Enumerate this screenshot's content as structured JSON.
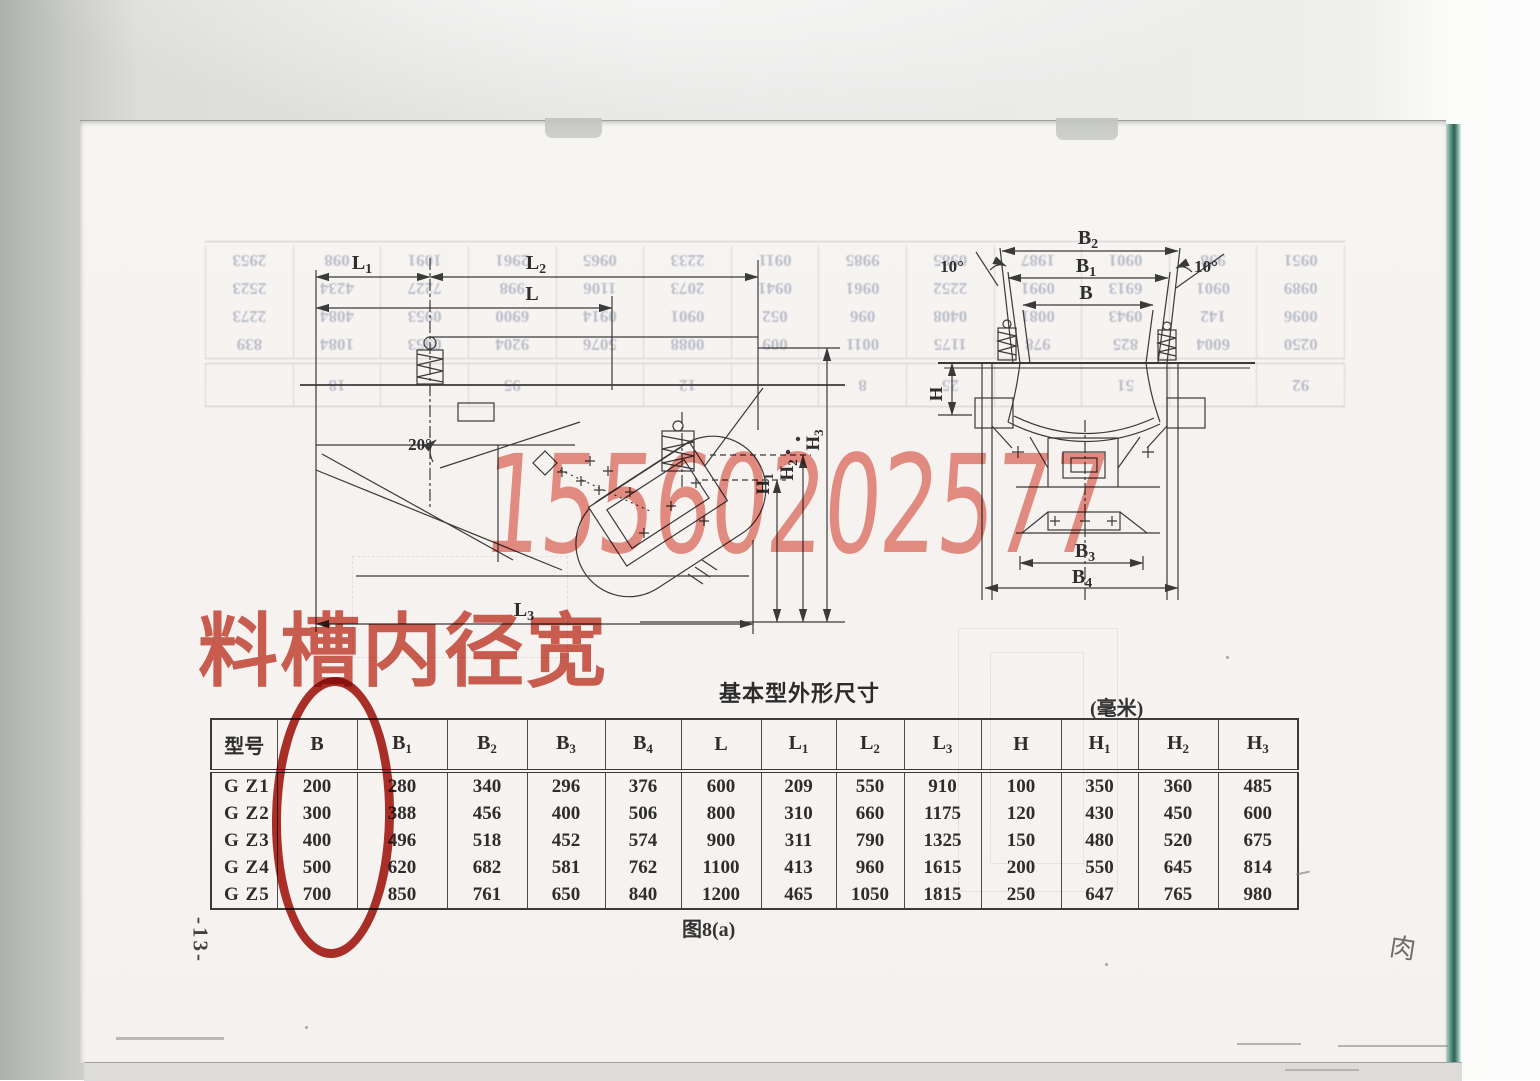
{
  "document": {
    "page_number": "-13-",
    "figure_caption": "图8(a)",
    "red_annotation_text": "料槽内径宽",
    "watermark_phone": "15560202577",
    "handwritten_mark": "肉"
  },
  "dimension_table": {
    "title": "基本型外形尺寸",
    "unit": "(毫米)",
    "model_header": "型号",
    "headers": [
      {
        "b": "B",
        "s": ""
      },
      {
        "b": "B",
        "s": "1"
      },
      {
        "b": "B",
        "s": "2"
      },
      {
        "b": "B",
        "s": "3"
      },
      {
        "b": "B",
        "s": "4"
      },
      {
        "b": "L",
        "s": ""
      },
      {
        "b": "L",
        "s": "1"
      },
      {
        "b": "L",
        "s": "2"
      },
      {
        "b": "L",
        "s": "3"
      },
      {
        "b": "H",
        "s": ""
      },
      {
        "b": "H",
        "s": "1"
      },
      {
        "b": "H",
        "s": "2"
      },
      {
        "b": "H",
        "s": "3"
      }
    ],
    "rows": [
      {
        "model": "G Z1",
        "values": [
          "200",
          "280",
          "340",
          "296",
          "376",
          "600",
          "209",
          "550",
          "910",
          "100",
          "350",
          "360",
          "485"
        ]
      },
      {
        "model": "G Z2",
        "values": [
          "300",
          "388",
          "456",
          "400",
          "506",
          "800",
          "310",
          "660",
          "1175",
          "120",
          "430",
          "450",
          "600"
        ]
      },
      {
        "model": "G Z3",
        "values": [
          "400",
          "496",
          "518",
          "452",
          "574",
          "900",
          "311",
          "790",
          "1325",
          "150",
          "480",
          "520",
          "675"
        ]
      },
      {
        "model": "G Z4",
        "values": [
          "500",
          "620",
          "682",
          "581",
          "762",
          "1100",
          "413",
          "960",
          "1615",
          "200",
          "550",
          "645",
          "814"
        ]
      },
      {
        "model": "G Z5",
        "values": [
          "700",
          "850",
          "761",
          "650",
          "840",
          "1200",
          "465",
          "1050",
          "1815",
          "250",
          "647",
          "765",
          "980"
        ]
      }
    ]
  },
  "side_view": {
    "labels": {
      "l1": {
        "b": "L",
        "s": "1"
      },
      "l2": {
        "b": "L",
        "s": "2"
      },
      "l": {
        "b": "L",
        "s": ""
      },
      "l3": {
        "b": "L",
        "s": "3"
      },
      "h1": {
        "b": "H",
        "s": "1"
      },
      "h2": {
        "b": "H",
        "s": "2"
      },
      "h3": {
        "b": "H",
        "s": "3"
      },
      "angle": "20°"
    }
  },
  "end_view": {
    "labels": {
      "b2": {
        "b": "B",
        "s": "2"
      },
      "b1": {
        "b": "B",
        "s": "1"
      },
      "b": {
        "b": "B",
        "s": ""
      },
      "b3": {
        "b": "B",
        "s": "3"
      },
      "b4": {
        "b": "B",
        "s": "4"
      },
      "h": {
        "b": "H",
        "s": ""
      },
      "angle_left": "10°",
      "angle_right": "10°"
    }
  },
  "bleedthrough": {
    "rows": [
      [
        "0250",
        "6004",
        "825",
        "978",
        "1175",
        "0011",
        "009",
        "0088",
        "5076",
        "9204",
        "0953",
        "1084",
        "839"
      ],
      [
        "0096",
        "142",
        "0943",
        "0081",
        "0408",
        "096",
        "052",
        "0901",
        "0914",
        "6900",
        "0953",
        "4084",
        "2273"
      ],
      [
        "0989",
        "0901",
        "6913",
        "0991",
        "2252",
        "0961",
        "0941",
        "2073",
        "1106",
        "998",
        "7227",
        "4234",
        "2523"
      ],
      [
        "0951",
        "998",
        "0901",
        "1987",
        "0985",
        "9985",
        "0911",
        "2233",
        "0965",
        "2961",
        "1091",
        "098",
        "2953"
      ]
    ],
    "footer": [
      "92",
      "",
      "51",
      "",
      "25",
      "8",
      "",
      "12",
      "",
      "95",
      "",
      "18",
      ""
    ]
  },
  "colors": {
    "red_text": "#c94a3c",
    "red_ellipse": "#a81e16",
    "watermark": "#e0584a",
    "ink": "#3a3a3a",
    "teal_edge": "#2c5f53"
  }
}
